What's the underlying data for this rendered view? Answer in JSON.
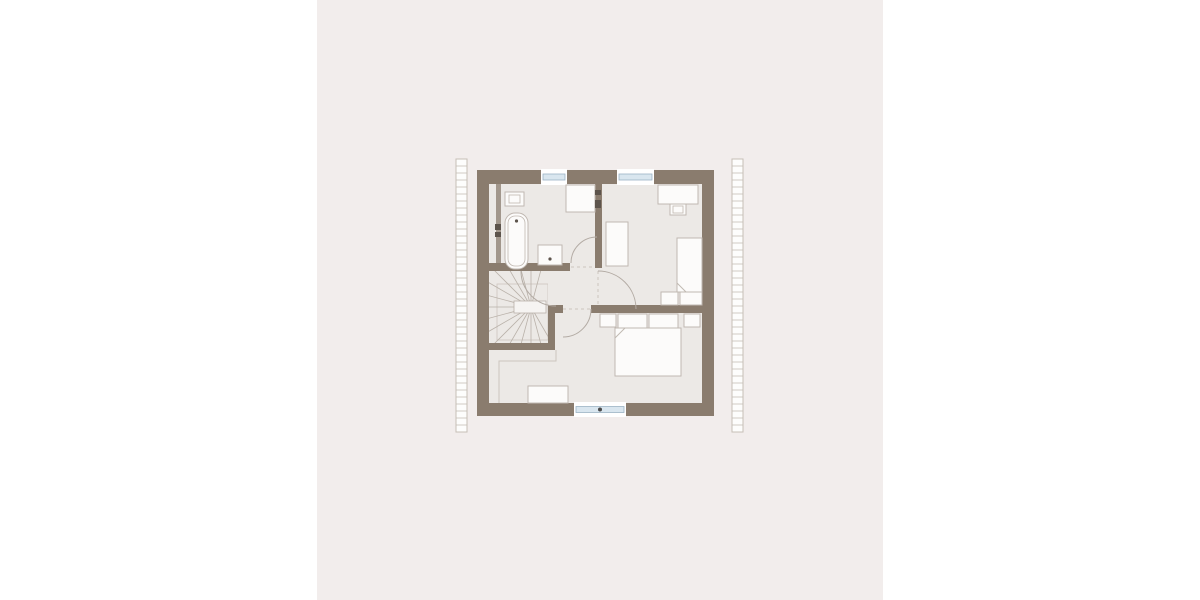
{
  "page": {
    "background": "#ffffff",
    "band": {
      "x": 317,
      "y": 0,
      "width": 566,
      "height": 600,
      "color": "#f2edec"
    }
  },
  "palette": {
    "wall": "#8a7c6e",
    "wall_light": "#a2978c",
    "floor": "#ece9e6",
    "furniture_fill": "#fcfbfa",
    "outline": "#c0b8b1",
    "hatch_line": "#c6beb6",
    "hatch_fill": "#fdfdfc",
    "tread_line": "#b9b1a9",
    "arc_line": "#b3aba4",
    "thin_line": "#ccc5be",
    "glazing_fill": "#d9e6ef",
    "glazing_stroke": "#9cb3c5",
    "dark_mark": "#5d544c",
    "handle": "#4a4a4a",
    "eye_fill": "#f6f4f2"
  },
  "plan": {
    "strips": [
      {
        "name": "roof-edge-strip-left",
        "x": 456,
        "y": 159,
        "width": 11,
        "height": 273,
        "rung_spacing": 7
      },
      {
        "name": "roof-edge-strip-right",
        "x": 732,
        "y": 159,
        "width": 11,
        "height": 273,
        "rung_spacing": 7
      }
    ],
    "floor": {
      "name": "floor-area",
      "x": 483,
      "y": 178,
      "width": 225,
      "height": 231
    },
    "walls": [
      {
        "name": "wall-exterior-top",
        "x": 477,
        "y": 170,
        "width": 237,
        "height": 14
      },
      {
        "name": "wall-exterior-bottom",
        "x": 477,
        "y": 403,
        "width": 237,
        "height": 13
      },
      {
        "name": "wall-exterior-left",
        "x": 477,
        "y": 170,
        "width": 12,
        "height": 246
      },
      {
        "name": "wall-exterior-right",
        "x": 702,
        "y": 170,
        "width": 12,
        "height": 246
      },
      {
        "name": "wall-bathroom-south",
        "x": 489,
        "y": 263,
        "width": 81,
        "height": 8
      },
      {
        "name": "wall-bathroom-east",
        "x": 595,
        "y": 184,
        "width": 7,
        "height": 84
      },
      {
        "name": "wall-bedroom-north-cap",
        "x": 555,
        "y": 305,
        "width": 8,
        "height": 8
      },
      {
        "name": "wall-bedroom-north-east",
        "x": 591,
        "y": 305,
        "width": 111,
        "height": 8
      },
      {
        "name": "wall-stair-east",
        "x": 548,
        "y": 305,
        "width": 7,
        "height": 45
      },
      {
        "name": "wall-stair-south",
        "x": 489,
        "y": 343,
        "width": 66,
        "height": 7
      },
      {
        "name": "wall-installation-shaft",
        "x": 496,
        "y": 184,
        "width": 5,
        "height": 79,
        "color": "#a2978c"
      }
    ],
    "windows": [
      {
        "name": "window-top-small",
        "x": 541,
        "y": 169,
        "width": 26,
        "height": 16,
        "handle": false
      },
      {
        "name": "window-top-large",
        "x": 617,
        "y": 169,
        "width": 37,
        "height": 16,
        "handle": false
      },
      {
        "name": "window-bottom",
        "x": 574,
        "y": 402,
        "width": 52,
        "height": 15,
        "handle": true
      }
    ],
    "doors": [
      {
        "name": "door-bathroom",
        "arc": "M571,263 A26,26 0 0 1 597,237",
        "threshold": [
          571,
          267,
          595,
          267
        ]
      },
      {
        "name": "door-child-room",
        "arc": "M598,271 A38,38 0 0 1 636,309",
        "threshold": [
          598,
          271,
          598,
          305
        ]
      },
      {
        "name": "door-bedroom",
        "arc": "M591,309 A28,28 0 0 1 563,337",
        "threshold": [
          563,
          309,
          591,
          309
        ]
      },
      {
        "name": "door-hall-stairs",
        "arc": "M556,306 A35,35 0 0 1 521,271",
        "threshold": null
      }
    ],
    "stairs": {
      "name": "winder-staircase",
      "clip": {
        "x": 489,
        "y": 271,
        "width": 59,
        "height": 72
      },
      "center": [
        531,
        307
      ],
      "tread_angles": [
        75,
        90,
        105,
        120,
        135,
        150,
        165,
        180,
        195,
        210,
        225,
        240,
        255,
        270,
        285,
        300
      ],
      "tread_length": 95,
      "well_outline": {
        "x": 497,
        "y": 284,
        "width": 51,
        "height": 56
      },
      "eye": {
        "x": 514,
        "y": 301,
        "width": 32,
        "height": 12
      }
    },
    "knee_line": {
      "name": "knee-wall-line",
      "points": "556,350 556,361 499,361 499,403"
    },
    "furniture": [
      {
        "name": "toilet",
        "x": 505,
        "y": 192,
        "width": 19,
        "height": 14,
        "inner": [
          509,
          195,
          11,
          8
        ]
      },
      {
        "name": "bathtub",
        "x": 505,
        "y": 213,
        "width": 23,
        "height": 56,
        "rx": 10,
        "inner_inset": 3,
        "dot": [
          516.5,
          221
        ]
      },
      {
        "name": "washbasin",
        "x": 538,
        "y": 245,
        "width": 24,
        "height": 20,
        "dot": [
          550,
          259
        ]
      },
      {
        "name": "shower",
        "x": 566,
        "y": 185,
        "width": 29,
        "height": 27
      },
      {
        "name": "wardrobe",
        "x": 606,
        "y": 222,
        "width": 22,
        "height": 44
      },
      {
        "name": "desk",
        "x": 658,
        "y": 185,
        "width": 40,
        "height": 19
      },
      {
        "name": "desk-chair",
        "x": 670,
        "y": 204,
        "width": 16,
        "height": 11,
        "inner": [
          673,
          206,
          10,
          7
        ]
      },
      {
        "name": "single-bed",
        "x": 677,
        "y": 238,
        "width": 25,
        "height": 54,
        "fold": [
          677,
          283,
          686,
          292
        ]
      },
      {
        "name": "chest-left",
        "x": 661,
        "y": 292,
        "width": 17,
        "height": 13
      },
      {
        "name": "chest-right",
        "x": 680,
        "y": 292,
        "width": 22,
        "height": 13
      },
      {
        "name": "nightstand-left",
        "x": 600,
        "y": 314,
        "width": 16,
        "height": 13
      },
      {
        "name": "pillow-left",
        "x": 618,
        "y": 314,
        "width": 29,
        "height": 14
      },
      {
        "name": "pillow-right",
        "x": 649,
        "y": 314,
        "width": 29,
        "height": 14
      },
      {
        "name": "nightstand-right",
        "x": 684,
        "y": 314,
        "width": 16,
        "height": 13
      },
      {
        "name": "double-bed",
        "x": 615,
        "y": 328,
        "width": 66,
        "height": 48,
        "fold": [
          615,
          338,
          625,
          328
        ]
      },
      {
        "name": "dresser",
        "x": 528,
        "y": 386,
        "width": 40,
        "height": 17
      }
    ],
    "marks": [
      {
        "name": "shower-fitting-mark",
        "x": 595,
        "y": 190,
        "width": 6,
        "height": 5
      },
      {
        "name": "shower-fitting-mark",
        "x": 595,
        "y": 200,
        "width": 6,
        "height": 8
      },
      {
        "name": "shaft-mark",
        "x": 495,
        "y": 224,
        "width": 6,
        "height": 6
      },
      {
        "name": "shaft-mark",
        "x": 495,
        "y": 232,
        "width": 6,
        "height": 5
      }
    ]
  }
}
